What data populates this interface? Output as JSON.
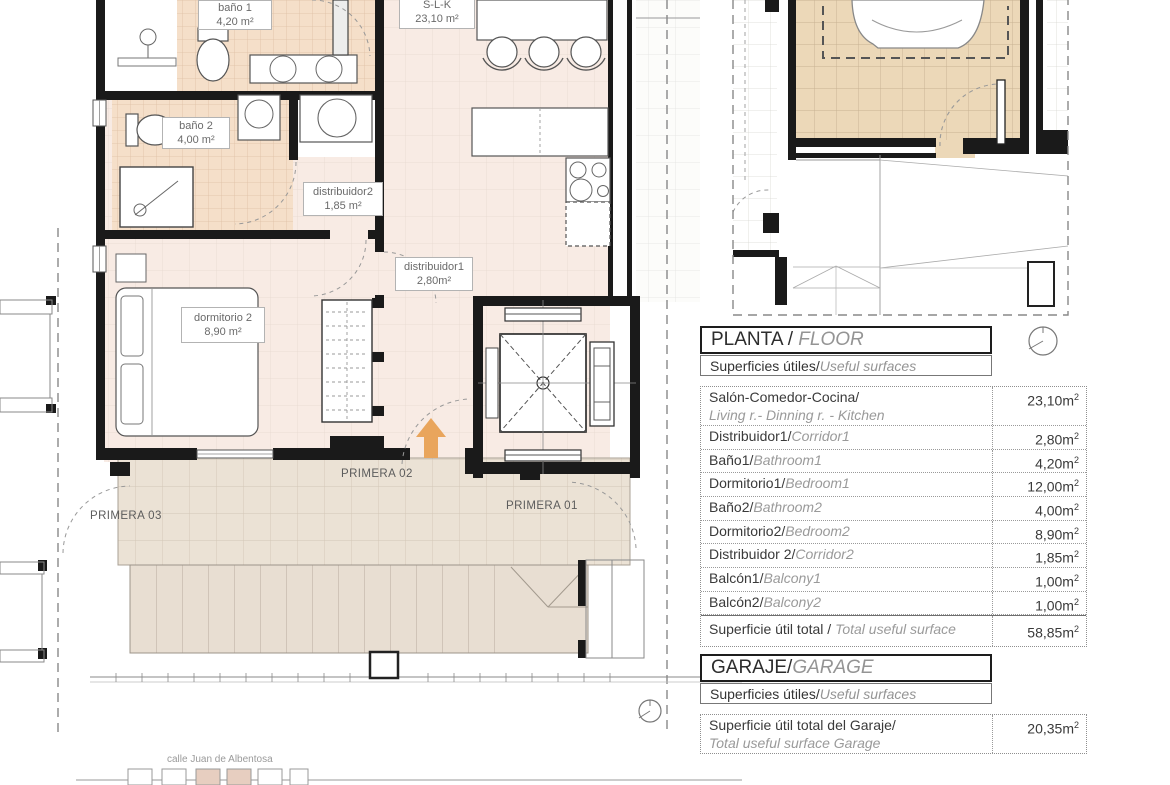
{
  "colors": {
    "wall": "#1a1a1a",
    "floor_pink": "#f8ebe4",
    "bath_tile": "#f5dfc9",
    "terrace": "#ebe2d5",
    "roof": "#e8ded2",
    "garage_floor": "#ecd8b8",
    "arrow_orange": "#e9a55c",
    "text_dark": "#3a3a3a",
    "text_italic_grey": "#949494"
  },
  "plan": {
    "room_labels": [
      {
        "name": "baño 1",
        "area": "4,20 m²"
      },
      {
        "name": "baño 2",
        "area": "4,00 m²"
      },
      {
        "name": "distribuidor2",
        "area": "1,85 m²"
      },
      {
        "name": "distribuidor1",
        "area": "2,80m²"
      },
      {
        "name": "dormitorio 2",
        "area": "8,90 m²"
      },
      {
        "name": "S-L-K",
        "area": "23,10 m²"
      }
    ],
    "unit_labels": [
      {
        "label": "PRIMERA 03"
      },
      {
        "label": "PRIMERA 02"
      },
      {
        "label": "PRIMERA 01"
      }
    ],
    "street_label": "calle Juan de Albentosa"
  },
  "floor_table": {
    "title": "PLANTA / ",
    "title_italic": "FLOOR",
    "subtitle": "Superficies útiles/",
    "subtitle_italic": "Useful surfaces",
    "rows": [
      {
        "es": "Salón-Comedor-Cocina/",
        "en": "Living r.- Dinning r. - Kitchen",
        "value": "23,10m²",
        "two_line": true
      },
      {
        "es": "Distribuidor1/",
        "en": "Corridor1",
        "value": "2,80m²"
      },
      {
        "es": "Baño1/",
        "en": "Bathroom1",
        "value": "4,20m²"
      },
      {
        "es": "Dormitorio1/",
        "en": "Bedroom1",
        "value": "12,00m²"
      },
      {
        "es": "Baño2/",
        "en": "Bathroom2",
        "value": "4,00m²"
      },
      {
        "es": "Dormitorio2/",
        "en": "Bedroom2",
        "value": "8,90m²"
      },
      {
        "es": "Distribuidor 2/",
        "en": "Corridor2",
        "value": "1,85m²"
      },
      {
        "es": "Balcón1/",
        "en": "Balcony1",
        "value": "1,00m²"
      },
      {
        "es": "Balcón2/",
        "en": "Balcony2",
        "value": "1,00m²"
      }
    ],
    "total": {
      "es": "Superficie útil total / ",
      "en": "Total useful surface",
      "value": "58,85m²"
    }
  },
  "garage_table": {
    "title": "GARAJE/",
    "title_italic": "GARAGE",
    "subtitle": "Superficies útiles/",
    "subtitle_italic": "Useful surfaces",
    "rows": [
      {
        "es": "Superficie útil total del Garaje/",
        "en": "Total useful surface Garage",
        "value": "20,35m²",
        "two_line": true
      }
    ]
  }
}
